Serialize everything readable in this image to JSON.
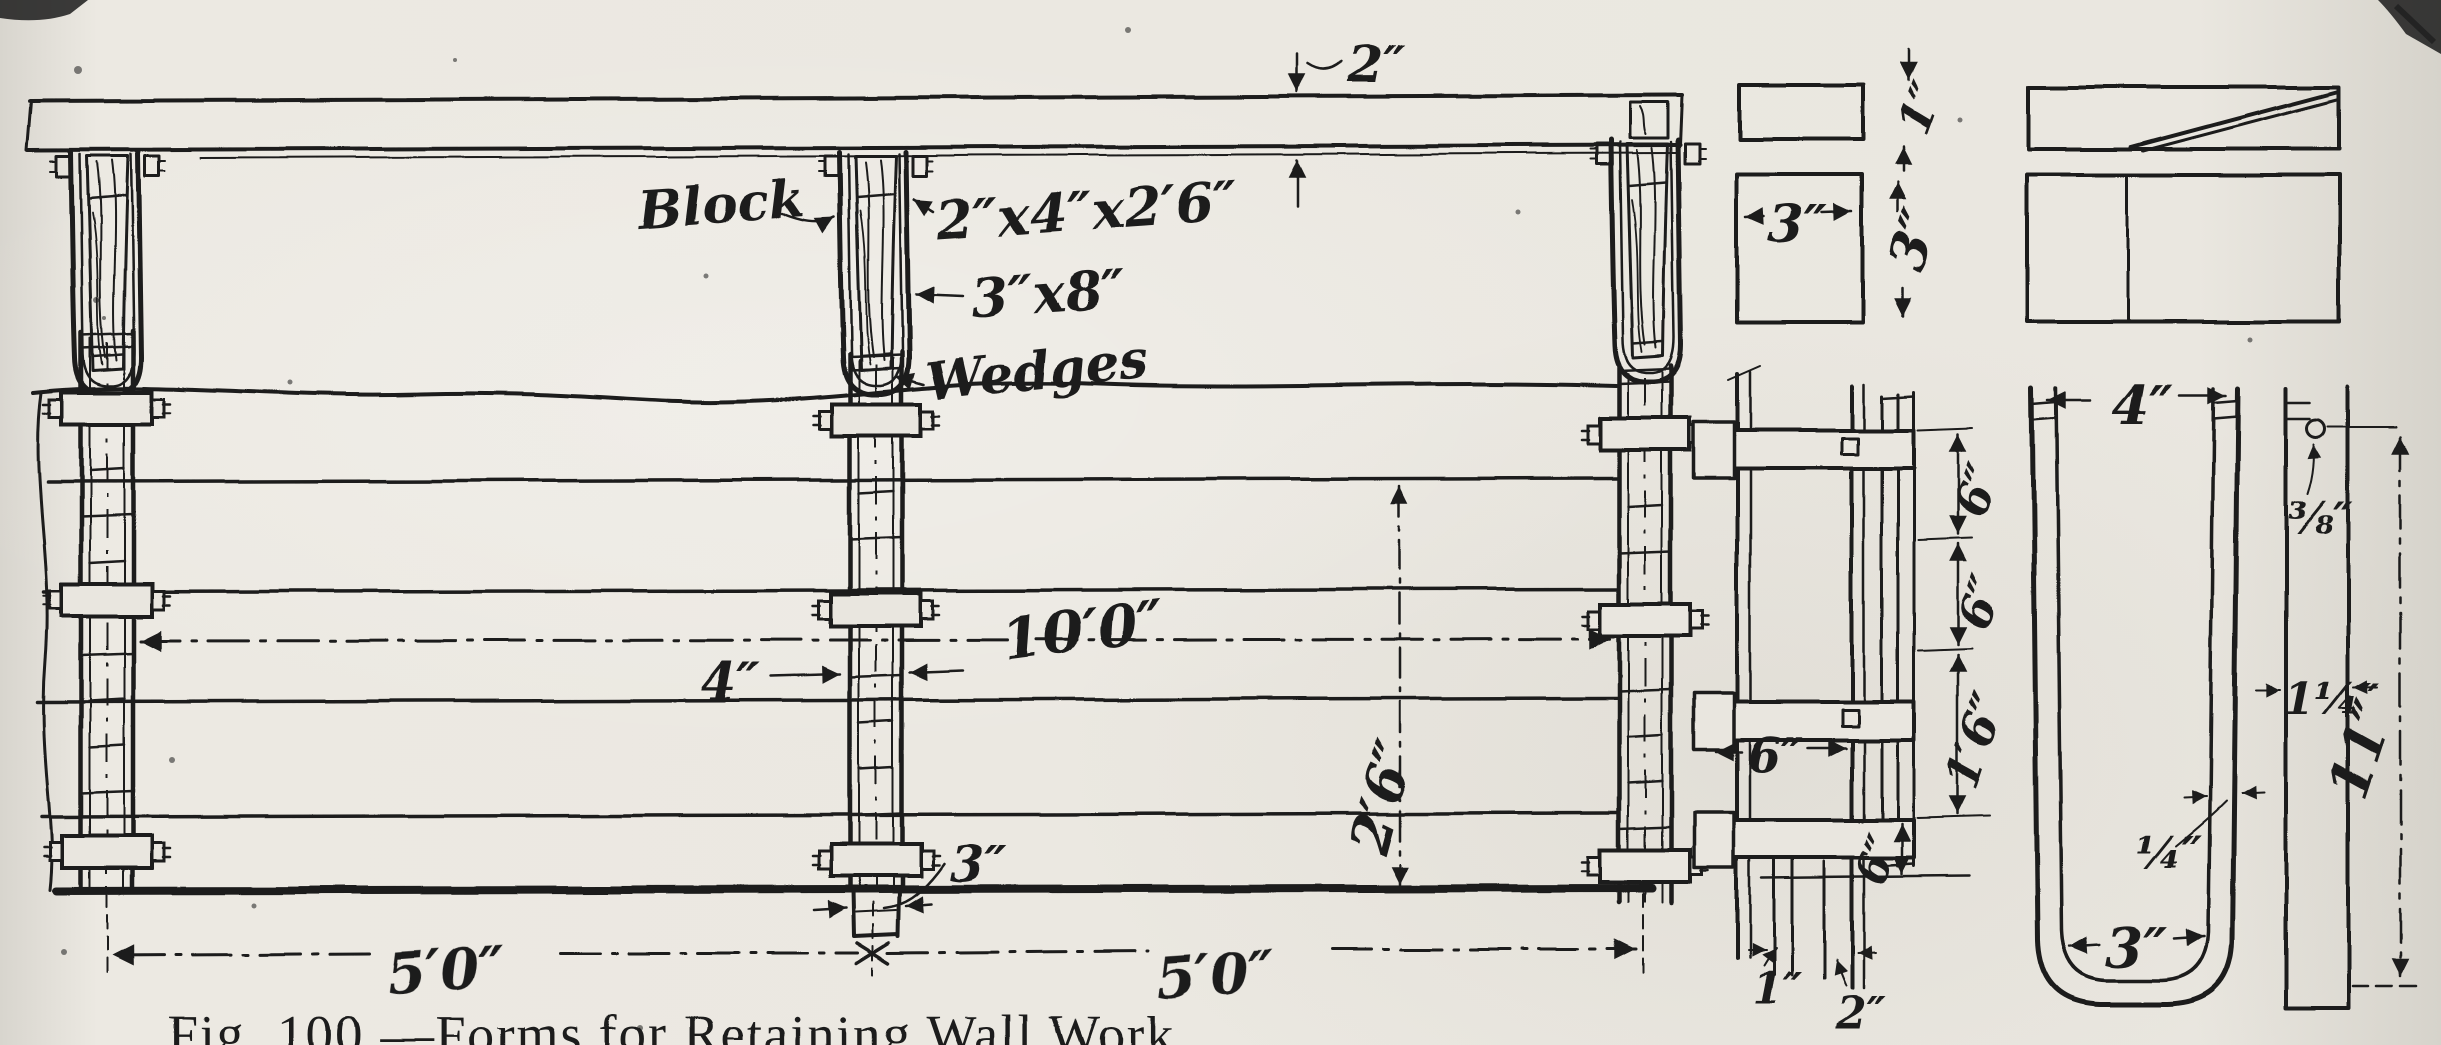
{
  "figure": {
    "caption": "Fig. 100.—Forms for Retaining Wall Work."
  },
  "colors": {
    "ink": "#1b1b1b",
    "paper": "#e9e6df"
  },
  "elevation": {
    "block_label": "Block",
    "block_size": "2″x4″x2′6″",
    "wedge_size": "3″x8″",
    "wedges_label": "Wedges",
    "plank_thickness": "2″",
    "post_width": "4″",
    "post_spacing": "10′0″",
    "post_foot_width": "3″",
    "form_height": "2′6″",
    "bay_left": "5′0″",
    "bay_right": "5′0″"
  },
  "post_detail": {
    "board_gap": "6″",
    "spacing_top": "6″",
    "spacing_mid": "6″",
    "spacing_main": "1′6″",
    "spacing_bottom": "6″",
    "sheathing_1": "1″",
    "sheathing_2": "2″"
  },
  "wedge_detail": {
    "plan_thickness": "1″",
    "plan_width": "3″",
    "plan_depth": "3″"
  },
  "strap_detail": {
    "leg_spread": "4″",
    "hole_diameter": "⅜″",
    "bar_width": "1¼″",
    "thickness": "¼″",
    "inner_width": "3″",
    "length": "11″"
  }
}
